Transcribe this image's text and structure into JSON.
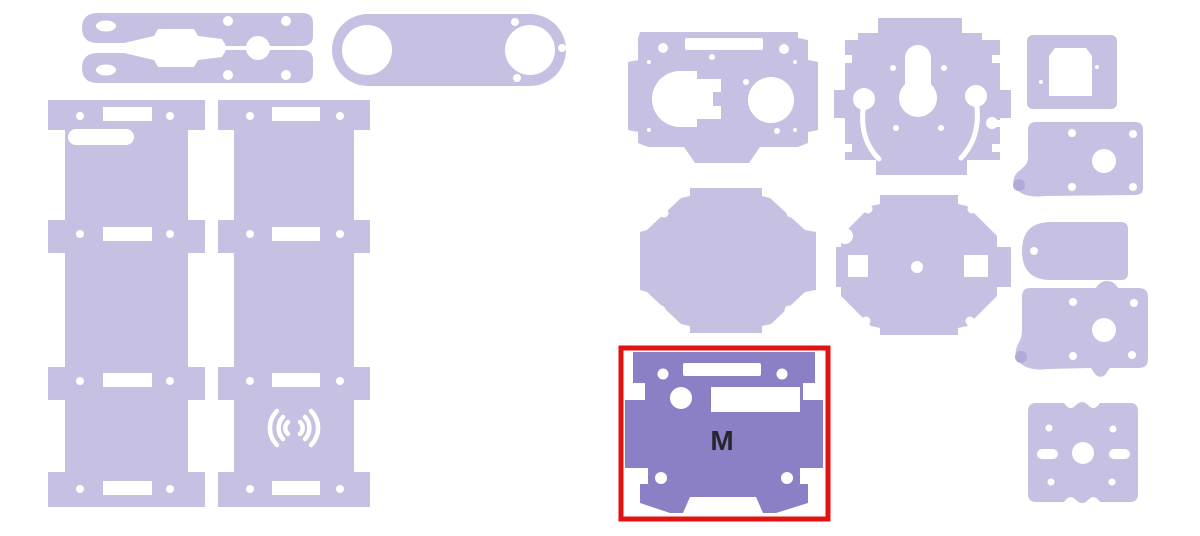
{
  "canvas": {
    "width": 1200,
    "height": 536
  },
  "colors": {
    "background": "#ffffff",
    "part_fill": "#c6c0e2",
    "selected_fill": "#8b80c6",
    "highlight_border": "#e31212",
    "label": "#26262e",
    "cutout": "#ffffff"
  },
  "selection": {
    "label": "M"
  },
  "parts": [
    {
      "id": "caliper-arms",
      "selected": false
    },
    {
      "id": "side-panel-1",
      "selected": false
    },
    {
      "id": "side-panel-2-speaker",
      "selected": false
    },
    {
      "id": "capsule-plate",
      "selected": false
    },
    {
      "id": "motor-plate",
      "selected": false
    },
    {
      "id": "keyhole-plate",
      "selected": false
    },
    {
      "id": "round-plate-plain",
      "selected": false
    },
    {
      "id": "round-plate-slots",
      "selected": false
    },
    {
      "id": "base-plate-m",
      "selected": true,
      "label": "M"
    },
    {
      "id": "window-plate",
      "selected": false
    },
    {
      "id": "side-plate-a",
      "selected": false
    },
    {
      "id": "tag-plate",
      "selected": false
    },
    {
      "id": "side-plate-b",
      "selected": false
    },
    {
      "id": "mount-plate",
      "selected": false
    }
  ]
}
